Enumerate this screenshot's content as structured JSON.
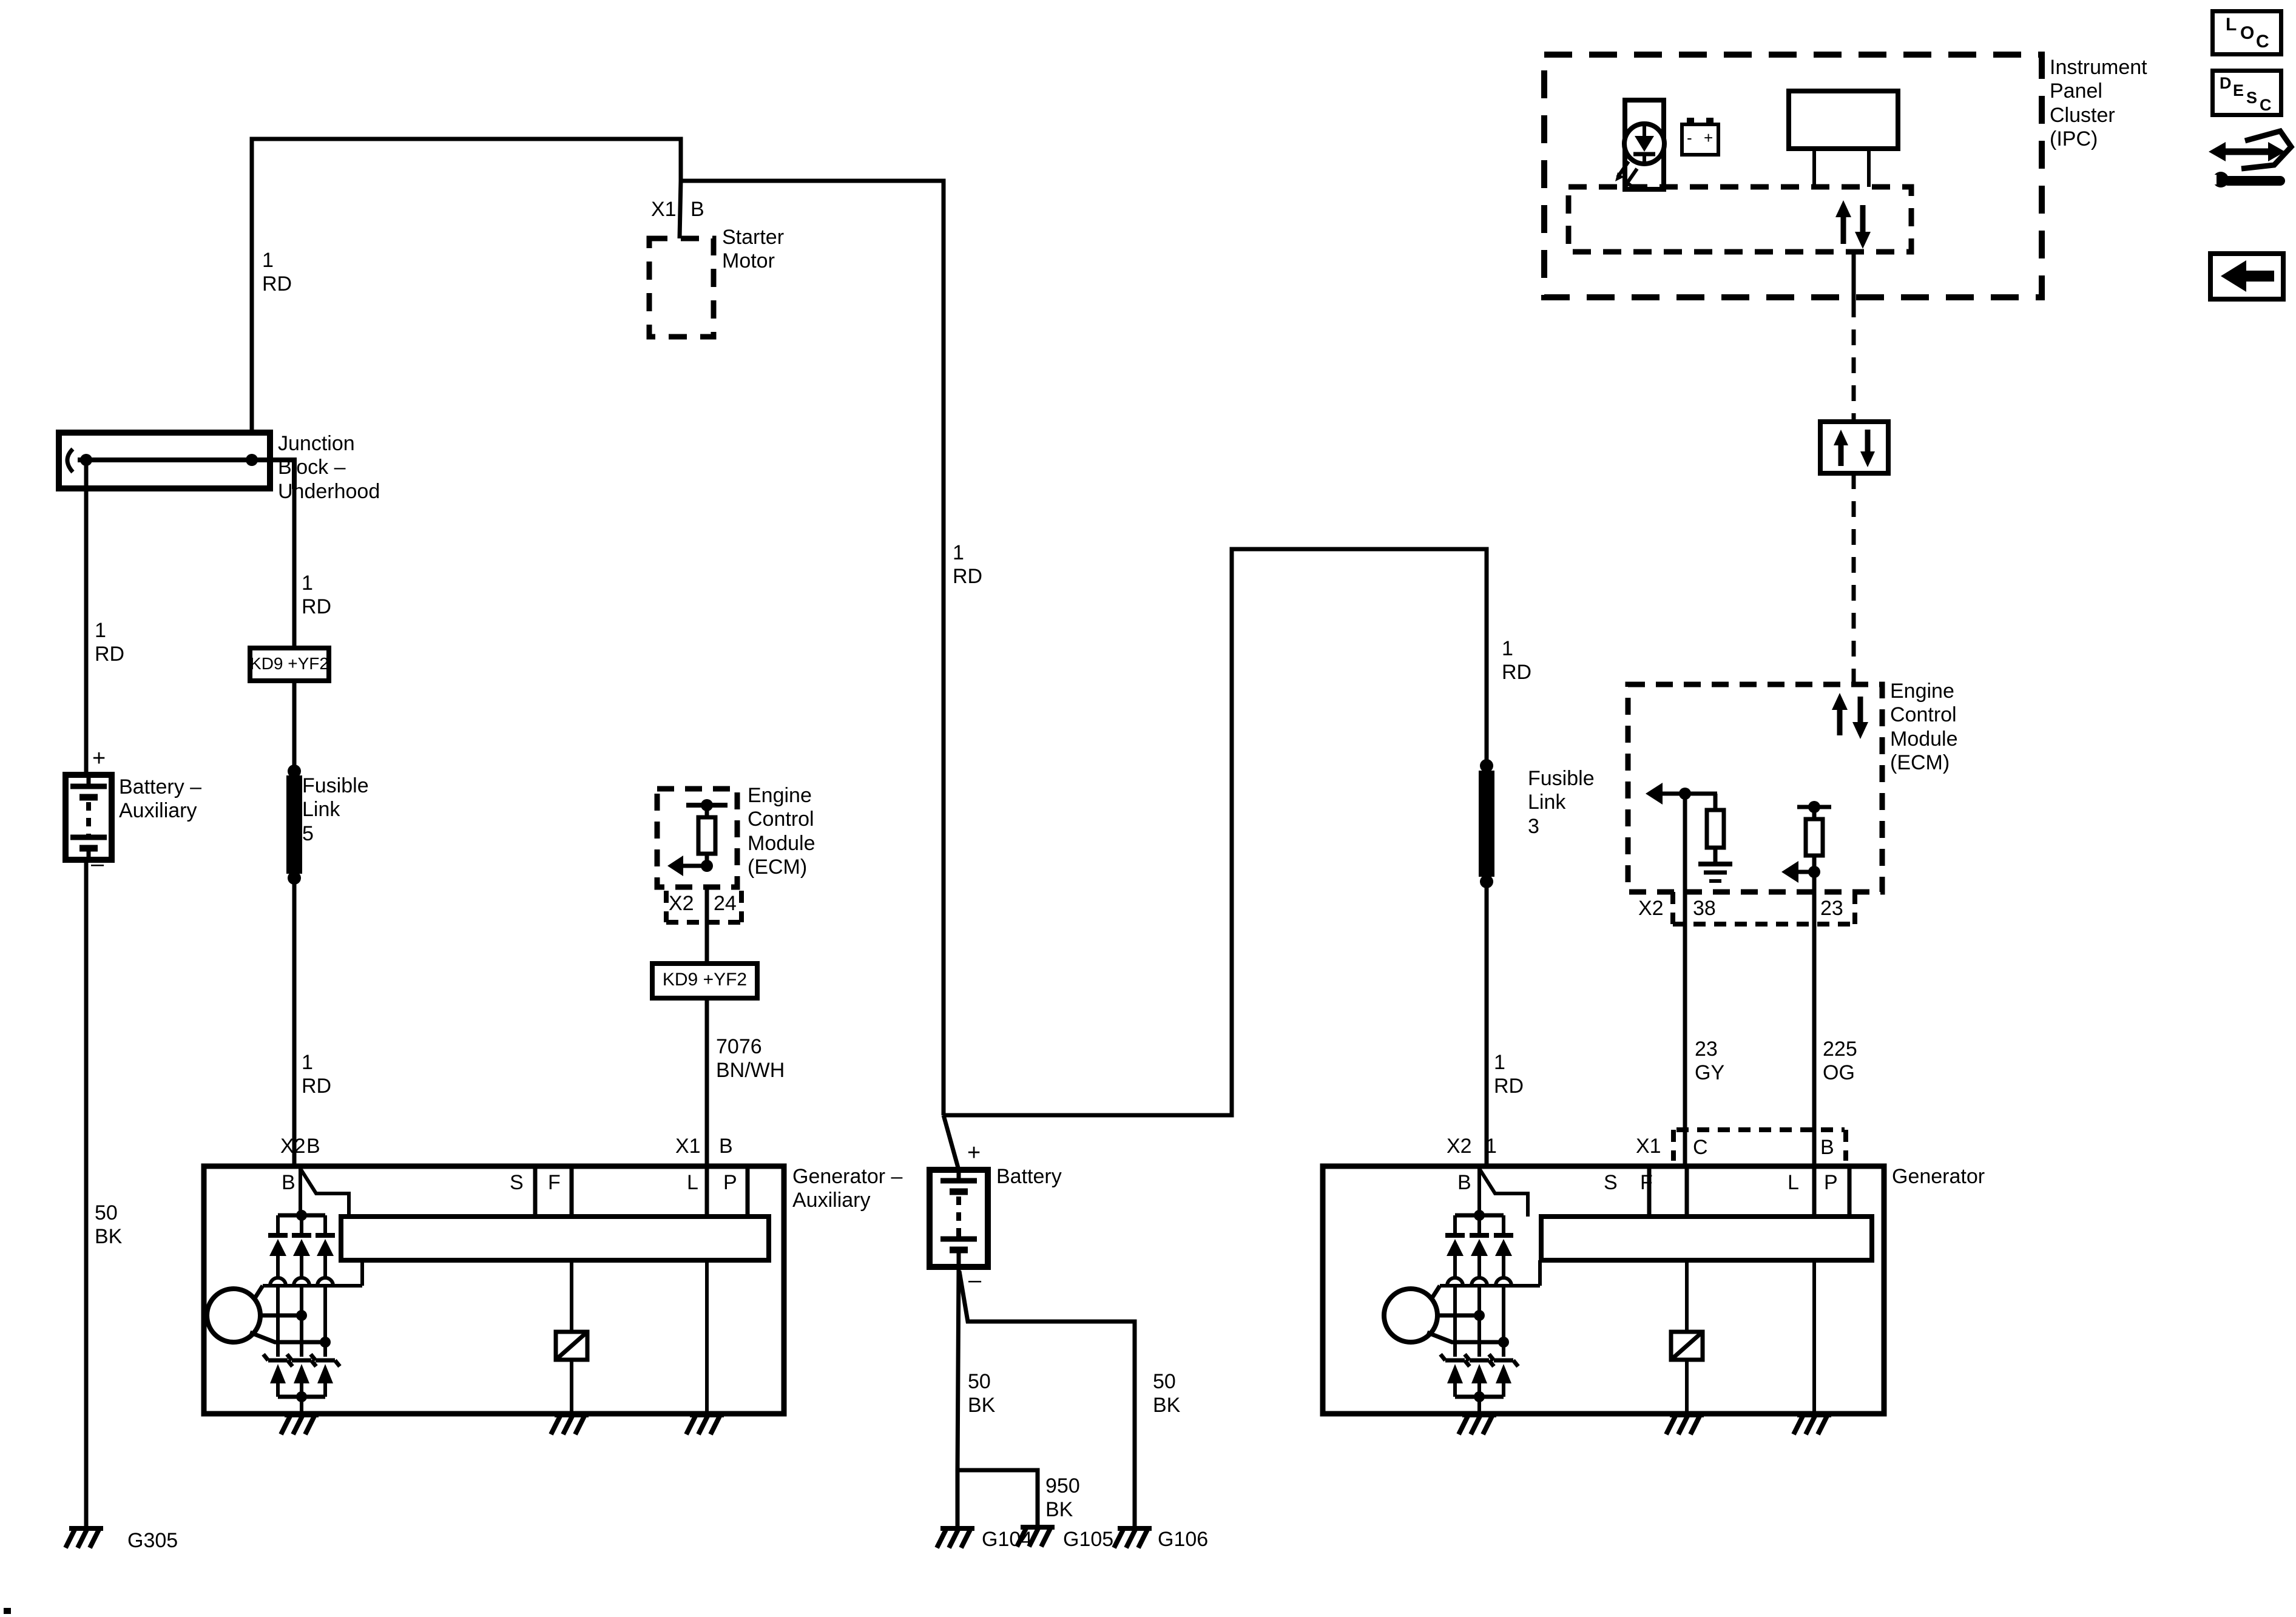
{
  "colors": {
    "ink": "#000000",
    "paper": "#ffffff"
  },
  "modules": {
    "ipc": "Instrument\nPanel\nCluster\n(IPC)",
    "starter": "Starter\nMotor",
    "junction_block": "Junction\nBlock –\nUnderhood",
    "battery_aux": "Battery –\nAuxiliary",
    "battery": "Battery",
    "fusible_link_5": "Fusible\nLink\n5",
    "fusible_link_3": "Fusible\nLink\n3",
    "ecm_left": "Engine\nControl\nModule\n(ECM)",
    "ecm_right": "Engine\nControl\nModule\n(ECM)",
    "generator_aux": "Generator –\nAuxiliary",
    "generator": "Generator",
    "kd9_left": "KD9 +YF2",
    "kd9_right": "KD9 +YF2"
  },
  "wires": {
    "rd_junction_riser": "1\nRD",
    "rd_battery_aux": "1\nRD",
    "rd_fl5_upper": "1\nRD",
    "rd_fl5_lower": "1\nRD",
    "rd_main": "1\nRD",
    "rd_fl3_upper": "1\nRD",
    "rd_fl3_lower": "1\nRD",
    "bnwh_7076": "7076\nBN/WH",
    "gy_23": "23\nGY",
    "og_225": "225\nOG",
    "bk50_left": "50\nBK",
    "bk50_mid": "50\nBK",
    "bk50_right": "50\nBK",
    "bk950": "950\nBK"
  },
  "grounds": {
    "g305": "G305",
    "g104": "G104",
    "g105": "G105",
    "g106": "G106"
  },
  "connectors": {
    "starter_x1": "X1",
    "starter_b": "B",
    "ecml_x2": "X2",
    "ecml_24": "24",
    "ecmr_x2": "X2",
    "ecmr_38": "38",
    "ecmr_23": "23",
    "genaux_x2": "X2",
    "genaux_b": "B",
    "genaux_x1": "X1",
    "genaux_x1b": "B",
    "genr_x2": "X2",
    "genr_1": "1",
    "genr_x1": "X1",
    "genr_c": "C",
    "genr_b": "B"
  },
  "terminals": {
    "aux_b": "B",
    "aux_s": "S",
    "aux_f": "F",
    "aux_l": "L",
    "aux_p": "P",
    "r_b": "B",
    "r_s": "S",
    "r_f": "F",
    "r_l": "L",
    "r_p": "P"
  },
  "polarity": {
    "aux_plus": "+",
    "aux_minus": "–",
    "mid_plus": "+",
    "mid_minus": "–",
    "ipc_minus": "-",
    "ipc_plus": "+"
  },
  "toolbar": {
    "loc_letters": [
      "L",
      "O",
      "C"
    ],
    "desc_letters": [
      "D",
      "E",
      "S",
      "C"
    ]
  }
}
